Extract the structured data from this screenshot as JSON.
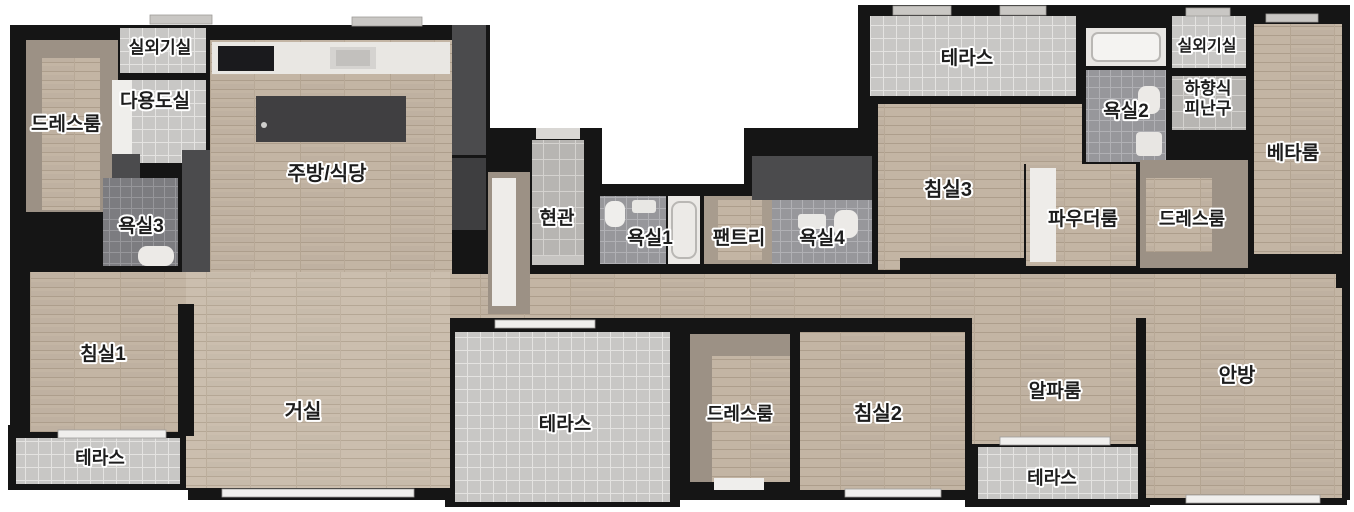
{
  "title": "apartment-floor-plan",
  "palette": {
    "wall": "#151515",
    "wood_floor": "#c3b5a4",
    "wood_floor_light": "#cbbeae",
    "terrace_tile": "#c8c7c5",
    "entry_tile": "#b7b5b2",
    "bath_tile": "#97979b",
    "bath_tile_dark": "#7c7c80",
    "closet_taupe": "#9c9185",
    "fixture_dark": "#4b4b4d",
    "counter_white": "#e9e7e3",
    "label_text": "#1d1d1d",
    "label_halo": "#ffffff"
  },
  "rooms": {
    "outdoor_unit_left": "실외기실",
    "dressroom_left": "드레스룸",
    "utility_room": "다용도실",
    "bathroom3": "욕실3",
    "kitchen_dining": "주방/식당",
    "entrance": "현관",
    "bathroom1": "욕실1",
    "pantry": "팬트리",
    "bathroom4": "욕실4",
    "bedroom3": "침실3",
    "terrace_top": "테라스",
    "bathroom2": "욕실2",
    "outdoor_unit_right": "실외기실",
    "escape_hatch_line1": "하향식",
    "escape_hatch_line2": "피난구",
    "beta_room": "베타룸",
    "powder_room": "파우더룸",
    "dressroom_right": "드레스룸",
    "bedroom1": "침실1",
    "living_room": "거실",
    "terrace_bottom_left": "테라스",
    "terrace_center": "테라스",
    "dressroom_center": "드레스룸",
    "bedroom2": "침실2",
    "alpha_room": "알파룸",
    "terrace_bottom_right": "테라스",
    "master_bedroom": "안방"
  }
}
